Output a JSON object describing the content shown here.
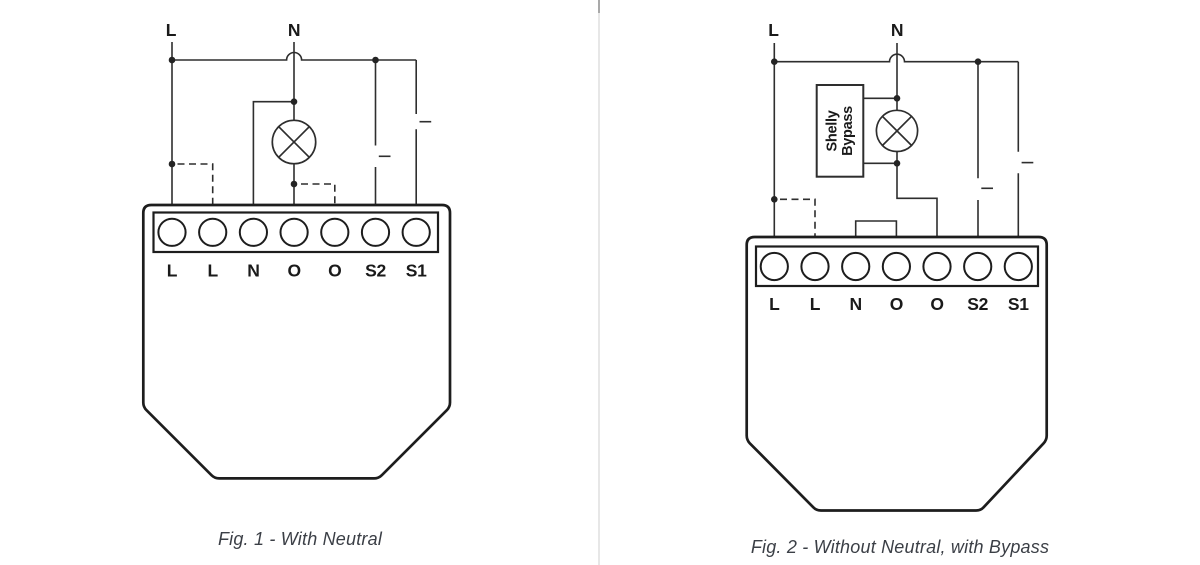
{
  "colors": {
    "background": "#ffffff",
    "wire": "#2e2e2e",
    "device_outline": "#1d1d1d",
    "junction_dot": "#242424",
    "label": "#1a1a1a",
    "caption": "#3b3f46",
    "divider": "#e7e7e7"
  },
  "fig1": {
    "caption": "Fig. 1 - With Neutral",
    "supply": {
      "l": "L",
      "n": "N"
    },
    "terminals": [
      "L",
      "L",
      "N",
      "O",
      "O",
      "S2",
      "S1"
    ]
  },
  "fig2": {
    "caption": "Fig. 2 - Without Neutral, with Bypass",
    "supply": {
      "l": "L",
      "n": "N"
    },
    "terminals": [
      "L",
      "L",
      "N",
      "O",
      "O",
      "S2",
      "S1"
    ],
    "bypass": {
      "line1": "Shelly",
      "line2": "Bypass"
    }
  }
}
